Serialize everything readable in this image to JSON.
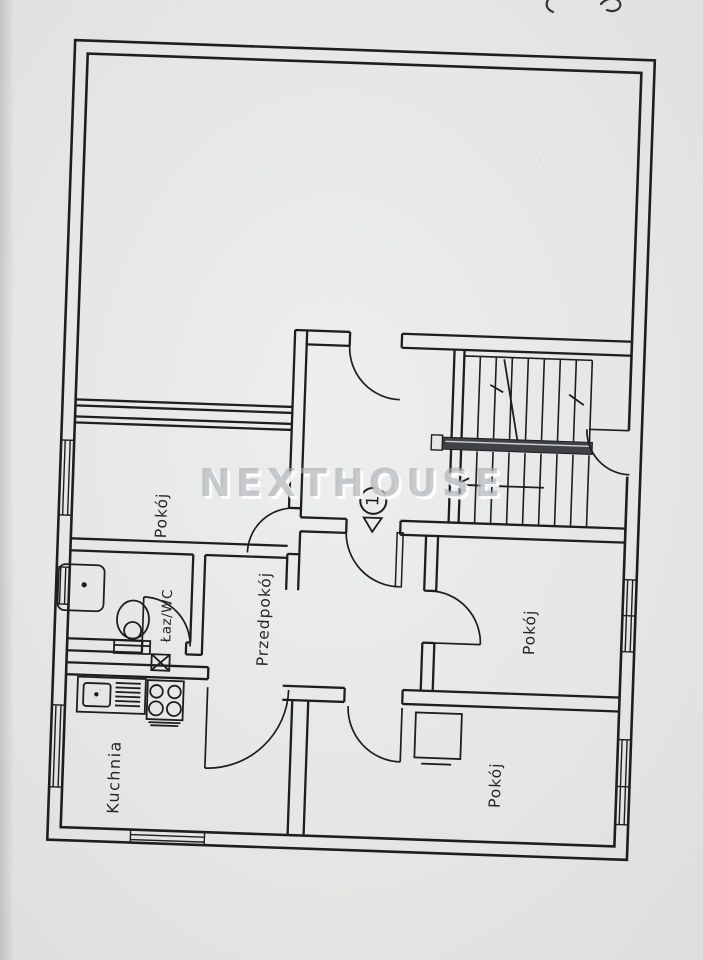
{
  "watermark": {
    "text": "NEXTHOUSE"
  },
  "entrance": {
    "number": "1"
  },
  "rooms": {
    "pokoj_left": {
      "label": "Pokój"
    },
    "przedpokoj": {
      "label": "Przedpokój"
    },
    "lazienka_wc": {
      "label": "Łaz/WC"
    },
    "kuchnia": {
      "label": "Kuchnia"
    },
    "pokoj_right_middle": {
      "label": "Pokój"
    },
    "pokoj_right_bottom": {
      "label": "Pokój"
    }
  },
  "symbols": {
    "staircase": "staircase-with-landing",
    "shower": "shower-tray",
    "toilet": "toilet",
    "sink": "kitchen-sink-with-drainer",
    "stove": "four-burner-stove",
    "vent": "vent-shaft",
    "wardrobe": "wardrobe",
    "entrance_arrow": "entrance-direction-arrow"
  },
  "colors": {
    "paper": "#e5e7e6",
    "ink": "#1d1e20",
    "watermark_gray": "#a9adb2",
    "handrail_dark": "#3f4145"
  }
}
